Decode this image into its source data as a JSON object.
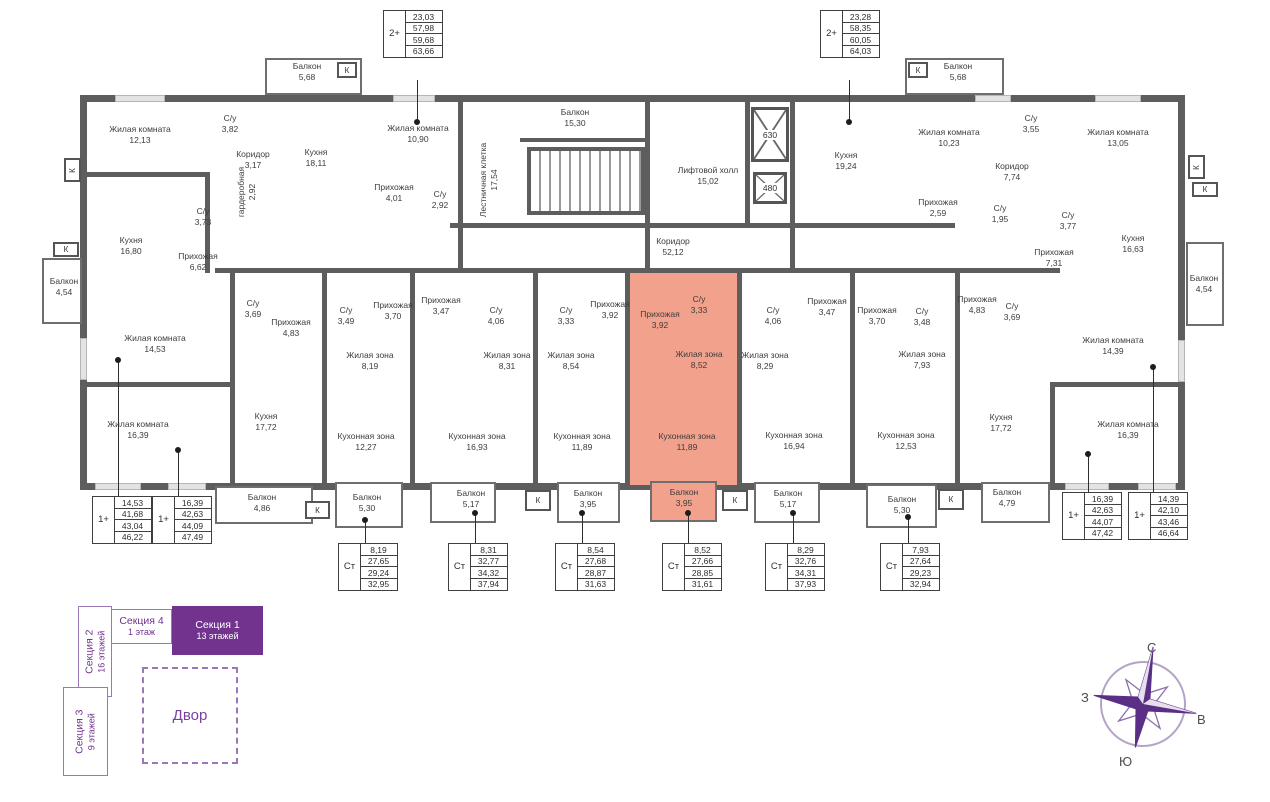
{
  "rooms": {
    "t1": {
      "name": "Жилая комната",
      "area": "12,13"
    },
    "t2": {
      "name": "С/у",
      "area": "3,82"
    },
    "t3": {
      "name": "Коридор",
      "area": "3,17"
    },
    "t4": {
      "name": "Кухня",
      "area": "18,11"
    },
    "t5": {
      "name": "гардеробная",
      "area": "2,92"
    },
    "t6": {
      "name": "Балкон",
      "area": "5,68"
    },
    "t7": {
      "name": "Жилая комната",
      "area": "10,90"
    },
    "t8": {
      "name": "Прихожая",
      "area": "4,01"
    },
    "t9": {
      "name": "С/у",
      "area": "2,92"
    },
    "t10": {
      "name": "Кухня",
      "area": "16,80"
    },
    "t11": {
      "name": "Прихожая",
      "area": "6,62"
    },
    "t12": {
      "name": "С/у",
      "area": "3,73"
    },
    "t13": {
      "name": "Балкон",
      "area": "4,54"
    },
    "t14": {
      "name": "Лестничная клетка",
      "area": "17,54"
    },
    "t15": {
      "name": "Балкон",
      "area": "15,30"
    },
    "t16": {
      "name": "Лифтовой холл",
      "area": "15,02"
    },
    "t17": {
      "name": "Коридор",
      "area": "52,12"
    },
    "t18": {
      "name": "Кухня",
      "area": "19,24"
    },
    "t19": {
      "name": "Жилая комната",
      "area": "10,23"
    },
    "t20": {
      "name": "С/у",
      "area": "3,55"
    },
    "t21": {
      "name": "Коридор",
      "area": "7,74"
    },
    "t22": {
      "name": "Жилая комната",
      "area": "13,05"
    },
    "t23": {
      "name": "Балкон",
      "area": "5,68"
    },
    "t24": {
      "name": "Прихожая",
      "area": "2,59"
    },
    "t25": {
      "name": "С/у",
      "area": "1,95"
    },
    "t26": {
      "name": "С/у",
      "area": "3,77"
    },
    "t27": {
      "name": "Кухня",
      "area": "16,63"
    },
    "t28": {
      "name": "Прихожая",
      "area": "7,31"
    },
    "t29": {
      "name": "Балкон",
      "area": "4,54"
    },
    "m1": {
      "name": "С/у",
      "area": "3,69"
    },
    "m2": {
      "name": "Прихожая",
      "area": "4,83"
    },
    "m3": {
      "name": "Жилая комната",
      "area": "14,53"
    },
    "m4": {
      "name": "Жилая комната",
      "area": "16,39"
    },
    "m5": {
      "name": "Кухня",
      "area": "17,72"
    },
    "s1a": {
      "name": "С/у",
      "area": "3,49"
    },
    "s1b": {
      "name": "Прихожая",
      "area": "3,70"
    },
    "s1c": {
      "name": "Жилая зона",
      "area": "8,19"
    },
    "s1d": {
      "name": "Кухонная зона",
      "area": "12,27"
    },
    "s2a": {
      "name": "Прихожая",
      "area": "3,47"
    },
    "s2b": {
      "name": "С/у",
      "area": "4,06"
    },
    "s2c": {
      "name": "Жилая зона",
      "area": "8,31"
    },
    "s2d": {
      "name": "Кухонная зона",
      "area": "16,93"
    },
    "s3a": {
      "name": "С/у",
      "area": "3,33"
    },
    "s3b": {
      "name": "Прихожая",
      "area": "3,92"
    },
    "s3c": {
      "name": "Жилая зона",
      "area": "8,54"
    },
    "s3d": {
      "name": "Кухонная зона",
      "area": "11,89"
    },
    "h1": {
      "name": "Прихожая",
      "area": "3,92"
    },
    "h2": {
      "name": "С/у",
      "area": "3,33"
    },
    "h3": {
      "name": "Жилая зона",
      "area": "8,52"
    },
    "h4": {
      "name": "Кухонная зона",
      "area": "11,89"
    },
    "s5a": {
      "name": "С/у",
      "area": "4,06"
    },
    "s5b": {
      "name": "Прихожая",
      "area": "3,47"
    },
    "s5c": {
      "name": "Жилая зона",
      "area": "8,29"
    },
    "s5d": {
      "name": "Кухонная зона",
      "area": "16,94"
    },
    "s6a": {
      "name": "Прихожая",
      "area": "3,70"
    },
    "s6b": {
      "name": "С/у",
      "area": "3,48"
    },
    "s6c": {
      "name": "Жилая зона",
      "area": "7,93"
    },
    "s6d": {
      "name": "Кухонная зона",
      "area": "12,53"
    },
    "m6": {
      "name": "Прихожая",
      "area": "4,83"
    },
    "m7": {
      "name": "С/у",
      "area": "3,69"
    },
    "m8": {
      "name": "Жилая комната",
      "area": "14,39"
    },
    "m9": {
      "name": "Кухня",
      "area": "17,72"
    },
    "m10": {
      "name": "Жилая комната",
      "area": "16,39"
    },
    "b1": {
      "name": "Балкон",
      "area": "4,86"
    },
    "b2": {
      "name": "Балкон",
      "area": "5,30"
    },
    "b3": {
      "name": "Балкон",
      "area": "5,17"
    },
    "b4": {
      "name": "Балкон",
      "area": "3,95"
    },
    "b5": {
      "name": "Балкон",
      "area": "3,95"
    },
    "b6": {
      "name": "Балкон",
      "area": "5,17"
    },
    "b7": {
      "name": "Балкон",
      "area": "5,30"
    },
    "b8": {
      "name": "Балкон",
      "area": "4,79"
    }
  },
  "cards": {
    "top_left": {
      "type": "2+",
      "values": [
        "23,03",
        "57,98",
        "59,68",
        "63,66"
      ]
    },
    "top_right": {
      "type": "2+",
      "values": [
        "23,28",
        "58,35",
        "60,05",
        "64,03"
      ]
    },
    "bl1": {
      "type": "1+",
      "values": [
        "14,53",
        "41,68",
        "43,04",
        "46,22"
      ]
    },
    "bl2": {
      "type": "1+",
      "values": [
        "16,39",
        "42,63",
        "44,09",
        "47,49"
      ]
    },
    "st1": {
      "type": "Ст",
      "values": [
        "8,19",
        "27,65",
        "29,24",
        "32,95"
      ]
    },
    "st2": {
      "type": "Ст",
      "values": [
        "8,31",
        "32,77",
        "34,32",
        "37,94"
      ]
    },
    "st3": {
      "type": "Ст",
      "values": [
        "8,54",
        "27,68",
        "28,87",
        "31,63"
      ]
    },
    "st4": {
      "type": "Ст",
      "values": [
        "8,52",
        "27,66",
        "28,85",
        "31,61"
      ]
    },
    "st5": {
      "type": "Ст",
      "values": [
        "8,29",
        "32,76",
        "34,31",
        "37,93"
      ]
    },
    "st6": {
      "type": "Ст",
      "values": [
        "7,93",
        "27,64",
        "29,23",
        "32,94"
      ]
    },
    "br1": {
      "type": "1+",
      "values": [
        "16,39",
        "42,63",
        "44,07",
        "47,42"
      ]
    },
    "br2": {
      "type": "1+",
      "values": [
        "14,39",
        "42,10",
        "43,46",
        "46,64"
      ]
    }
  },
  "elevators": {
    "big": "630",
    "small": "480"
  },
  "k_label": "К",
  "site_plan": {
    "section1": {
      "name": "Секция 1",
      "floors": "13 этажей"
    },
    "section2": {
      "name": "Секция 2",
      "floors": "16 этажей"
    },
    "section3": {
      "name": "Секция 3",
      "floors": "9 этажей"
    },
    "section4": {
      "name": "Секция 4",
      "floors": "1 этаж"
    },
    "courtyard": "Двор"
  },
  "compass": {
    "n": "С",
    "s": "Ю",
    "w": "З",
    "e": "В"
  },
  "colors": {
    "highlight": "#f2a28c",
    "purple": "#71338d",
    "wall": "#5d5d5d"
  }
}
